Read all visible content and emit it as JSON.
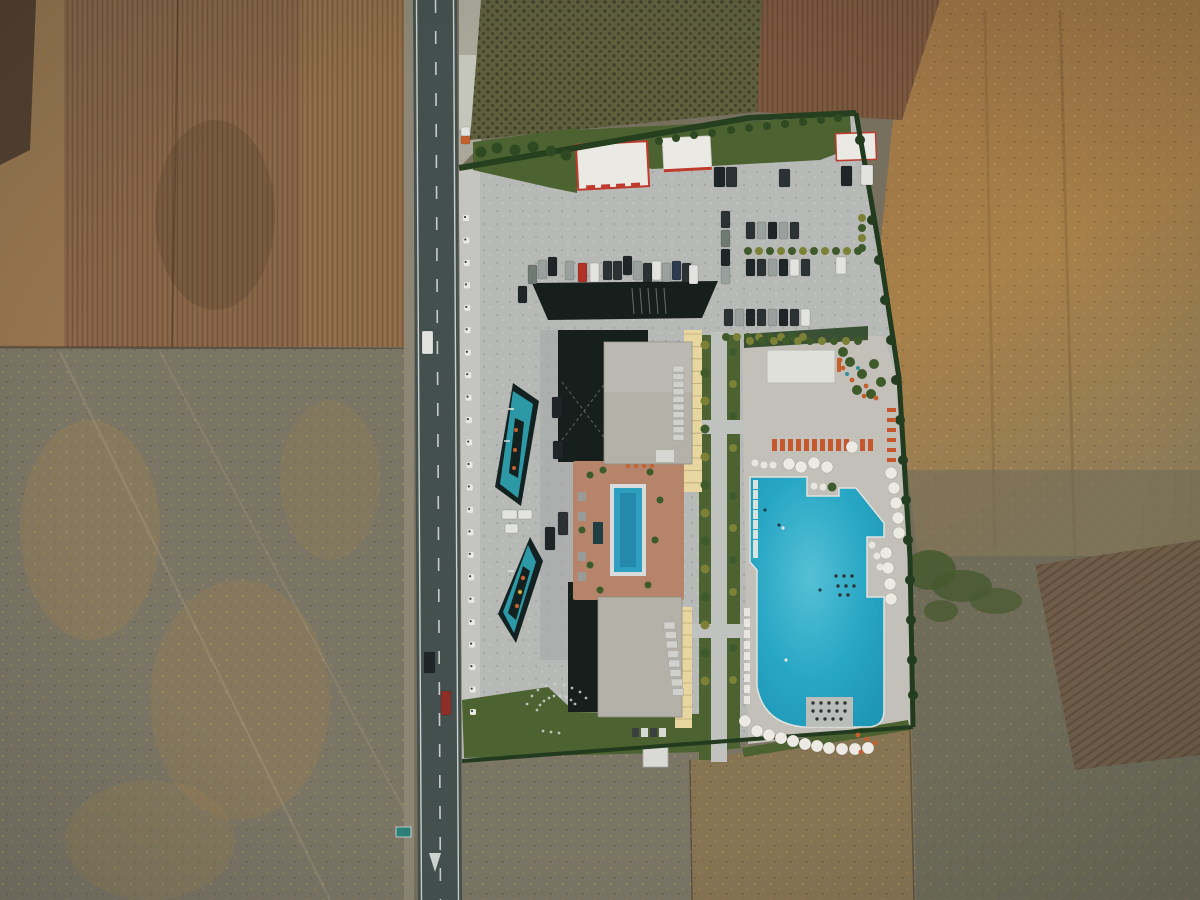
{
  "meta": {
    "description": "Top-down aerial drone photo of a resort hotel with two pools and parking lots beside a two-lane rural road, surrounded by dry farmland",
    "width": 1200,
    "height": 900
  },
  "palette": {
    "scrubLeft": "#77705e",
    "plow1": "#8a684a",
    "plowEdge": "#97764f",
    "darkCorner": "#54402f",
    "orchard": "#5f5f3e",
    "plowRed": "#7d5940",
    "fieldRight": "#9c7244",
    "scrubRight": "#6f6c59",
    "plowDiag": "#6f5c47",
    "bottomLeftField": "#7b7565",
    "bottomMidField": "#8a7450",
    "roadAsphalt": "#44504e",
    "roadShoulder": "#8d8674",
    "roadLine": "#e3e7e2",
    "gravelBright": "#c9cbc2",
    "pave": "#b7b9b6",
    "paveWarm": "#c3c0b9",
    "courtyard": "#a4a8a5",
    "curbStrip": "#c4c5c1",
    "lawn": "#4c6231",
    "hedge": "#243d1d",
    "treeYellow": "#7c8138",
    "treeGreen": "#3f5a2a",
    "darkIsland": "#161f1b",
    "bldgWhite": "#ebe9e3",
    "red": "#bf3a2c",
    "roofGray": "#b4b1a9",
    "skylight": "#d0d1cd",
    "cream": "#e8d6a0",
    "creamLine": "#b7a678",
    "terrace": "#b5846b",
    "spa": "#1f3f45",
    "pool": "#28a7c4",
    "poolLight": "#55c0d6",
    "poolDeep": "#1d95b4",
    "lapPool": "#2f9fc0",
    "decoPool": "#2d99a6",
    "decoDark": "#132220",
    "umbrella": "#eceae2",
    "lounger": "#c4572d",
    "orange": "#c4602f",
    "truckRed": "#8d2f26",
    "carWhite": "#e2e3e1",
    "carSilver": "#9aa09e",
    "carGray": "#6f7a74",
    "carDark": "#2c3234",
    "carBlack": "#202628",
    "carRed": "#b03226",
    "carBlue": "#2e3b4e"
  },
  "scene": {
    "cars": [
      [
        528,
        265,
        9,
        19,
        "carGray"
      ],
      [
        538,
        260,
        9,
        19,
        "carSilver"
      ],
      [
        548,
        257,
        9,
        19,
        "carBlack"
      ],
      [
        565,
        261,
        9,
        19,
        "carSilver"
      ],
      [
        578,
        263,
        9,
        19,
        "carRed"
      ],
      [
        590,
        263,
        9,
        19,
        "carWhite"
      ],
      [
        603,
        261,
        9,
        19,
        "carDark"
      ],
      [
        613,
        261,
        9,
        19,
        "carDark"
      ],
      [
        623,
        256,
        9,
        19,
        "carBlack"
      ],
      [
        633,
        261,
        9,
        19,
        "carSilver"
      ],
      [
        643,
        263,
        9,
        19,
        "carDark"
      ],
      [
        652,
        261,
        9,
        19,
        "carWhite"
      ],
      [
        662,
        263,
        9,
        19,
        "carSilver"
      ],
      [
        672,
        261,
        9,
        19,
        "carBlue"
      ],
      [
        682,
        263,
        9,
        19,
        "carDark"
      ],
      [
        689,
        265,
        9,
        19,
        "carWhite"
      ],
      [
        518,
        286,
        9,
        17,
        "carBlack"
      ],
      [
        714,
        167,
        11,
        20,
        "carBlack"
      ],
      [
        726,
        167,
        11,
        20,
        "carDark"
      ],
      [
        779,
        169,
        11,
        18,
        "carDark"
      ],
      [
        841,
        166,
        11,
        20,
        "carBlack"
      ],
      [
        861,
        165,
        12,
        20,
        "carWhite"
      ],
      [
        721,
        211,
        9,
        17,
        "carDark"
      ],
      [
        721,
        230,
        9,
        17,
        "carGray"
      ],
      [
        721,
        249,
        9,
        17,
        "carBlack"
      ],
      [
        721,
        267,
        9,
        17,
        "carSilver"
      ],
      [
        746,
        222,
        9,
        17,
        "carDark"
      ],
      [
        757,
        222,
        9,
        17,
        "carSilver"
      ],
      [
        768,
        222,
        9,
        17,
        "carBlack"
      ],
      [
        779,
        222,
        9,
        17,
        "carSilver"
      ],
      [
        790,
        222,
        9,
        17,
        "carDark"
      ],
      [
        746,
        259,
        9,
        17,
        "carBlack"
      ],
      [
        757,
        259,
        9,
        17,
        "carDark"
      ],
      [
        768,
        259,
        9,
        17,
        "carSilver"
      ],
      [
        779,
        259,
        9,
        17,
        "carBlack"
      ],
      [
        790,
        259,
        9,
        17,
        "carWhite"
      ],
      [
        801,
        259,
        9,
        17,
        "carDark"
      ],
      [
        836,
        257,
        10,
        17,
        "carWhite"
      ],
      [
        724,
        309,
        9,
        17,
        "carDark"
      ],
      [
        735,
        309,
        9,
        17,
        "carSilver"
      ],
      [
        746,
        309,
        9,
        17,
        "carBlack"
      ],
      [
        757,
        309,
        9,
        17,
        "carDark"
      ],
      [
        768,
        309,
        9,
        17,
        "carSilver"
      ],
      [
        779,
        309,
        9,
        17,
        "carBlack"
      ],
      [
        790,
        309,
        9,
        17,
        "carDark"
      ],
      [
        801,
        309,
        9,
        17,
        "carWhite"
      ],
      [
        502,
        510,
        15,
        9,
        "carWhite"
      ],
      [
        518,
        510,
        14,
        9,
        "carWhite"
      ],
      [
        505,
        524,
        13,
        9,
        "carWhite"
      ],
      [
        545,
        527,
        10,
        23,
        "carBlack"
      ],
      [
        558,
        512,
        10,
        23,
        "carDark"
      ],
      [
        552,
        397,
        10,
        21,
        "carBlack"
      ],
      [
        553,
        441,
        10,
        18,
        "carBlack"
      ],
      [
        422,
        331,
        11,
        23,
        "carWhite"
      ],
      [
        424,
        652,
        11,
        21,
        "carBlack"
      ],
      [
        441,
        691,
        10,
        24,
        "truckRed"
      ],
      [
        461,
        127,
        9,
        9,
        "carWhite"
      ],
      [
        461,
        136,
        9,
        8,
        "orange"
      ]
    ],
    "umbrellas": [
      [
        789,
        464
      ],
      [
        801,
        467
      ],
      [
        814,
        463
      ],
      [
        827,
        467
      ],
      [
        852,
        447
      ],
      [
        891,
        473
      ],
      [
        894,
        488
      ],
      [
        896,
        503
      ],
      [
        898,
        518
      ],
      [
        899,
        533
      ],
      [
        886,
        553
      ],
      [
        888,
        568
      ],
      [
        890,
        584
      ],
      [
        891,
        599
      ],
      [
        757,
        731
      ],
      [
        769,
        735
      ],
      [
        781,
        738
      ],
      [
        793,
        741
      ],
      [
        805,
        744
      ],
      [
        817,
        746
      ],
      [
        829,
        748
      ],
      [
        842,
        749
      ],
      [
        855,
        749
      ],
      [
        868,
        748
      ],
      [
        745,
        721
      ]
    ],
    "small_whites": [
      [
        755,
        463
      ],
      [
        764,
        465
      ],
      [
        773,
        465
      ],
      [
        814,
        486
      ],
      [
        823,
        487
      ],
      [
        872,
        545
      ],
      [
        877,
        556
      ],
      [
        880,
        567
      ]
    ],
    "white_loungers_pool": [
      480,
      490,
      500,
      510,
      520,
      530,
      540,
      549
    ],
    "white_loungers_walk": [
      608,
      619,
      630,
      641,
      652,
      663,
      674,
      685,
      696
    ],
    "orange_loungers_x": [
      772,
      780,
      788,
      796,
      804,
      812,
      820,
      828,
      836,
      844,
      860,
      868
    ],
    "red_loungers_y": [
      408,
      418,
      428,
      438,
      448,
      458
    ],
    "red_dots": [
      [
        858,
        735
      ],
      [
        867,
        739
      ],
      [
        875,
        743
      ],
      [
        861,
        752
      ],
      [
        840,
        360
      ],
      [
        843,
        368
      ],
      [
        852,
        380
      ],
      [
        866,
        386
      ],
      [
        864,
        396
      ],
      [
        876,
        398
      ]
    ],
    "bollards": {
      "x1": 466,
      "y1": 218,
      "x2": 473,
      "y2": 712,
      "count": 23
    },
    "trees_walk_left": [
      345,
      373,
      401,
      429,
      457,
      485,
      513,
      541,
      569,
      597,
      625,
      653,
      681
    ],
    "trees_walk_right": [
      352,
      384,
      416,
      448,
      496,
      528,
      560,
      592,
      648,
      680
    ],
    "hedge_trees_parking_x": [
      748,
      759,
      770,
      781,
      792,
      803,
      814,
      825,
      836,
      847,
      858
    ],
    "hedge_trees_vert_y": [
      218,
      228,
      238,
      248
    ],
    "hedge_trees_row4_x": [
      726,
      737,
      748,
      759,
      770,
      781,
      792,
      803
    ],
    "hedge_trees_pool_x": [
      750,
      762,
      774,
      786,
      798,
      810,
      822,
      834,
      846,
      858
    ],
    "lawn_trees_topleft": [
      [
        481,
        152
      ],
      [
        497,
        148
      ],
      [
        515,
        150
      ],
      [
        533,
        147
      ],
      [
        551,
        151
      ],
      [
        566,
        155
      ]
    ],
    "lawn_trees_topmid": [
      [
        659,
        141
      ],
      [
        676,
        138
      ],
      [
        694,
        135
      ],
      [
        712,
        133
      ],
      [
        731,
        130
      ],
      [
        749,
        128
      ],
      [
        767,
        126
      ],
      [
        785,
        124
      ],
      [
        803,
        122
      ],
      [
        821,
        120
      ],
      [
        838,
        118
      ]
    ],
    "boundary_trees_right": [
      [
        860,
        140
      ],
      [
        866,
        180
      ],
      [
        872,
        220
      ],
      [
        879,
        260
      ],
      [
        885,
        300
      ],
      [
        891,
        340
      ],
      [
        896,
        380
      ],
      [
        900,
        420
      ],
      [
        903,
        460
      ],
      [
        906,
        500
      ],
      [
        908,
        540
      ],
      [
        910,
        580
      ],
      [
        911,
        620
      ],
      [
        912,
        660
      ],
      [
        913,
        695
      ]
    ],
    "playground_greens": [
      [
        850,
        362
      ],
      [
        862,
        374
      ],
      [
        874,
        364
      ],
      [
        857,
        390
      ],
      [
        871,
        394
      ],
      [
        881,
        382
      ],
      [
        843,
        352
      ]
    ],
    "teal_dots": [
      [
        858,
        368
      ],
      [
        847,
        374
      ]
    ],
    "stepping_dots": [
      [
        537,
        710
      ],
      [
        540,
        705
      ],
      [
        544,
        701
      ],
      [
        549,
        698
      ],
      [
        554,
        696
      ],
      [
        560,
        696
      ],
      [
        566,
        697
      ],
      [
        571,
        700
      ],
      [
        575,
        704
      ],
      [
        527,
        704
      ],
      [
        532,
        696
      ],
      [
        538,
        690
      ],
      [
        546,
        686
      ],
      [
        555,
        684
      ],
      [
        564,
        685
      ],
      [
        572,
        688
      ],
      [
        580,
        692
      ],
      [
        586,
        698
      ],
      [
        543,
        731
      ],
      [
        551,
        732
      ],
      [
        559,
        733
      ]
    ],
    "inpool_dark_dots": [
      [
        813,
        703
      ],
      [
        821,
        703
      ],
      [
        829,
        703
      ],
      [
        837,
        703
      ],
      [
        845,
        703
      ],
      [
        813,
        711
      ],
      [
        821,
        711
      ],
      [
        829,
        711
      ],
      [
        837,
        711
      ],
      [
        845,
        711
      ],
      [
        817,
        719
      ],
      [
        825,
        719
      ],
      [
        833,
        719
      ],
      [
        841,
        719
      ],
      [
        836,
        576
      ],
      [
        844,
        576
      ],
      [
        852,
        576
      ],
      [
        838,
        586
      ],
      [
        846,
        586
      ],
      [
        854,
        586
      ],
      [
        840,
        595
      ],
      [
        848,
        595
      ]
    ],
    "pool_people": [
      [
        779,
        525
      ],
      [
        783,
        528
      ],
      [
        820,
        590
      ],
      [
        786,
        660
      ],
      [
        765,
        510
      ]
    ],
    "terrace_trees": [
      [
        590,
        475
      ],
      [
        603,
        470
      ],
      [
        650,
        472
      ],
      [
        660,
        500
      ],
      [
        655,
        540
      ],
      [
        590,
        565
      ],
      [
        600,
        590
      ],
      [
        648,
        585
      ],
      [
        582,
        530
      ]
    ],
    "terrace_orange_dots": [
      [
        628,
        466
      ],
      [
        636,
        466
      ],
      [
        644,
        466
      ],
      [
        652,
        466
      ]
    ],
    "island_hatch": [
      [
        632,
        288
      ],
      [
        640,
        288
      ],
      [
        648,
        288
      ],
      [
        656,
        288
      ],
      [
        664,
        288
      ]
    ],
    "skylights_upper_count": 10,
    "skylights_lower_count": 8
  }
}
